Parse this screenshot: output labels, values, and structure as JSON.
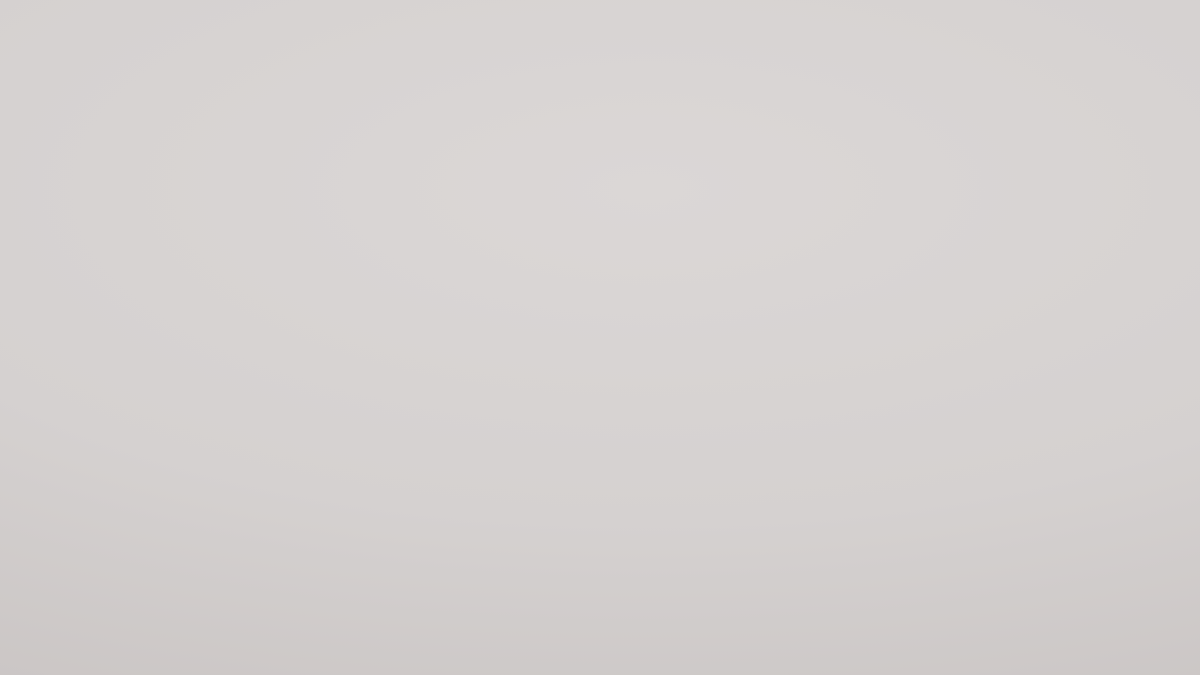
{
  "scene": {
    "description": "Isometric 3D render of 29 square low-poly terrain diorama tiles arranged on a light gray studio floor",
    "floor": {
      "light": "#dbd7d6",
      "mid": "#d5d1d0",
      "dark": "#c7c2c1"
    },
    "palettes": {
      "drill": {
        "ground": "#8c8263",
        "g2": "#6b6449",
        "side": "#79704f"
      },
      "cabinrock": {
        "ground": "#e9e4dd",
        "g2": "#c5bcb1",
        "side": "#cdc5ba"
      },
      "powerplant": {
        "ground": "#98989e",
        "g2": "#7e7e85",
        "side": "#85858c"
      },
      "refinery": {
        "ground": "#929298",
        "g2": "#7a7a81",
        "side": "#818188"
      },
      "snowmoss": {
        "ground": "#d8dbc9",
        "g2": "#b2b899",
        "side": "#bec2ab"
      },
      "olivehill": {
        "ground": "#a7a45e",
        "g2": "#c2bf79",
        "side": "#8e8b4e"
      },
      "rockysnow": {
        "ground": "#7d6c58",
        "g2": "#63523f",
        "side": "#6d5d48"
      },
      "steeppeak": {
        "ground": "#35502b",
        "g2": "#24371c",
        "side": "#2d4423"
      },
      "silos": {
        "ground": "#8b8672",
        "g2": "#6e6a57",
        "side": "#7a7663"
      },
      "farm": {
        "ground": "#d4a930",
        "g2": "#8a6c1c",
        "side": "#a5894b"
      },
      "fuji": {
        "ground": "#b4afa6",
        "g2": "#938e85",
        "side": "#a09b92",
        "water": "#2a4a66"
      },
      "oredirt": {
        "ground": "#b06227",
        "g2": "#8c4d1e",
        "side": "#96521f"
      },
      "solar": {
        "ground": "#5e5c4b",
        "g2": "#48473a",
        "side": "#504e3f",
        "panel": "#222933"
      },
      "city": {
        "ground": "#b4a98d",
        "g2": "#9b9076",
        "side": "#a1977c"
      },
      "mtngrass": {
        "ground": "#56b747",
        "g2": "#3d9a33",
        "side": "#47a139",
        "rock": "#e4dfd5"
      },
      "wind": {
        "ground": "#3fa63b",
        "g2": "#2c7f28",
        "side": "#35902d"
      },
      "oilrig": {
        "ground": "#1b374f",
        "g2": "#2d5472",
        "side": "#23445d"
      },
      "island1": {
        "ground": "#27485f",
        "g2": "#35607c",
        "side": "#9aa29a",
        "rock": "#cbd0c6",
        "green": "#4cb83b",
        "water": "#27485f"
      },
      "island2": {
        "ground": "#d9dbd3",
        "g2": "#bfc2b8",
        "side": "#c2c4ba",
        "rock": "#d9dbd3",
        "green": "#54ba3e",
        "water": "#5e7e92"
      },
      "darkvolcano": {
        "ground": "#273621",
        "g2": "#1a2616",
        "side": "#1f2c1a"
      },
      "sandcanyon": {
        "ground": "#cda65d",
        "g2": "#b38c49",
        "side": "#b18f4f",
        "rock": "#e5ded2",
        "canyon": "#443a2c"
      },
      "yellowrock": {
        "ground": "#e8e2d7",
        "g2": "#c7bcab",
        "side": "#c2a75e"
      },
      "foresttanks": {
        "ground": "#3a512e",
        "g2": "#283b20",
        "side": "#304626",
        "gravel": "#6e6654"
      },
      "whitecanyon": {
        "ground": "#ebe6df",
        "g2": "#c3bab0",
        "side": "#d1cac1",
        "dark": "#181411"
      },
      "bridge": {
        "ground": "#2c516f",
        "g2": "#1f3c55",
        "side": "#24435c",
        "rock": "#cfc8bb"
      },
      "shrubs": {
        "ground": "#dcd8d1",
        "g2": "#b7b0a7",
        "side": "#c5bfb7"
      },
      "dunes": {
        "ground": "#d5c684",
        "g2": "#b7a369",
        "side": "#99824f"
      },
      "greenriver": {
        "ground": "#689f55",
        "g2": "#4c8040",
        "side": "#4fae35",
        "rock": "#e6e0d6",
        "river": "#0d0c0a"
      },
      "bigvolcano": {
        "ground": "#2c401f",
        "g2": "#1d2d14",
        "side": "#243418"
      }
    },
    "tiles": [
      {
        "name": "drill-tower-site",
        "type": "drill",
        "label": "Mining drill tower on barren mossy hill",
        "x": 262,
        "y": 148,
        "s": 0.89
      },
      {
        "name": "rocky-plateau-cabin",
        "type": "cabinrock",
        "label": "White rocky plateau with log cabin",
        "x": 390,
        "y": 150,
        "s": 1.12
      },
      {
        "name": "coal-power-plant",
        "type": "powerplant",
        "label": "Dark power plant with chimneys and trucks",
        "x": 485,
        "y": 125,
        "s": 1.14
      },
      {
        "name": "oil-refinery",
        "type": "refinery",
        "label": "Refinery with storage tank and tall stacks",
        "x": 583,
        "y": 116,
        "s": 1.0
      },
      {
        "name": "snowy-crag",
        "type": "snowmoss",
        "label": "Jagged snow peak on mossy rock",
        "x": 652,
        "y": 93,
        "s": 1.06
      },
      {
        "name": "grassy-hill",
        "type": "olivehill",
        "label": "Smooth olive grass hill",
        "x": 710,
        "y": 84,
        "s": 1.0
      },
      {
        "name": "rocky-snow-mountain",
        "type": "rockysnow",
        "label": "Brown rocky mountain with snow patches",
        "x": 763,
        "y": 104,
        "s": 1.2
      },
      {
        "name": "alpine-peak",
        "type": "steeppeak",
        "label": "Steep snowy peak over dark forest",
        "x": 845,
        "y": 142,
        "s": 0.97
      },
      {
        "name": "grain-silos",
        "type": "silos",
        "label": "Silver silo farm ringed by trees",
        "x": 290,
        "y": 224,
        "s": 1.05
      },
      {
        "name": "crop-field",
        "type": "farm",
        "label": "Golden crop rows with crop-duster plane",
        "x": 415,
        "y": 192,
        "s": 1.1
      },
      {
        "name": "snow-volcano",
        "type": "fuji",
        "label": "Snow-covered volcano cone above water",
        "x": 518,
        "y": 172,
        "s": 1.08
      },
      {
        "name": "open-pit-mine",
        "type": "oredirt",
        "label": "Orange plowed mine with yellow dump truck",
        "x": 688,
        "y": 129,
        "s": 1.05
      },
      {
        "name": "solar-farm",
        "type": "solar",
        "label": "Solar panel arrays in pine forest",
        "x": 757,
        "y": 168,
        "s": 1.12
      },
      {
        "name": "white-city",
        "type": "city",
        "label": "White low-poly city blocks with trees",
        "x": 655,
        "y": 194,
        "s": 1.0
      },
      {
        "name": "mountain-meadow",
        "type": "mtngrass",
        "label": "Rocky ridge with green meadow corners",
        "x": 897,
        "y": 186,
        "s": 1.12
      },
      {
        "name": "wind-farm",
        "type": "wind",
        "label": "Leafy green meadow with wind turbines",
        "x": 310,
        "y": 301,
        "s": 1.0
      },
      {
        "name": "offshore-oil-rig",
        "type": "oilrig",
        "label": "Offshore oil rig and tanker in deep water",
        "x": 445,
        "y": 285,
        "s": 1.0
      },
      {
        "name": "green-island",
        "type": "island1",
        "label": "Green island on rock shelf in blue water",
        "x": 565,
        "y": 221,
        "s": 1.1
      },
      {
        "name": "rocky-islands",
        "type": "island2",
        "label": "Rocky islets with grass in shallow water",
        "x": 835,
        "y": 219,
        "s": 1.05
      },
      {
        "name": "jungle-volcano",
        "type": "darkvolcano",
        "label": "Dark jungle volcano cone",
        "x": 736,
        "y": 256,
        "s": 1.12
      },
      {
        "name": "desert-canyon",
        "type": "sandcanyon",
        "label": "Winding dark canyon in golden sand",
        "x": 653,
        "y": 287,
        "s": 0.92
      },
      {
        "name": "limestone-plateau",
        "type": "yellowrock",
        "label": "White rocky plateau with golden cliffs",
        "x": 1020,
        "y": 257,
        "s": 1.15
      },
      {
        "name": "forest-fuel-tanks",
        "type": "foresttanks",
        "label": "White storage tanks hidden in dense forest",
        "x": 493,
        "y": 310,
        "s": 1.07
      },
      {
        "name": "karst-caves",
        "type": "whitecanyon",
        "label": "White karst terrain with dark caves",
        "x": 340,
        "y": 406,
        "s": 0.97
      },
      {
        "name": "stone-bridge",
        "type": "bridge",
        "label": "Stone bridge crossing a blue river",
        "x": 910,
        "y": 294,
        "s": 0.85
      },
      {
        "name": "scrubland",
        "type": "shrubs",
        "label": "Pale gravel scrub with boulders and shrubs",
        "x": 818,
        "y": 329,
        "s": 1.05
      },
      {
        "name": "sand-dunes",
        "type": "dunes",
        "label": "Rippled golden sand dunes",
        "x": 697,
        "y": 384,
        "s": 0.87
      },
      {
        "name": "highland-river",
        "type": "greenriver",
        "label": "Green highland with rock outcrops and gorge",
        "x": 558,
        "y": 473,
        "s": 1.0
      },
      {
        "name": "forest-volcano",
        "type": "bigvolcano",
        "label": "Vast forested volcano with gray summit",
        "x": 375,
        "y": 551,
        "s": 1.02
      }
    ]
  }
}
